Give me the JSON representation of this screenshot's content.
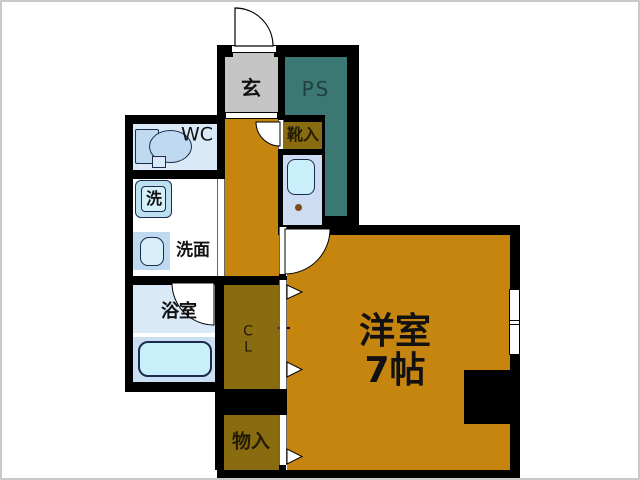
{
  "title": "apartment-floor-plan",
  "rooms": {
    "genkan": {
      "label": "玄"
    },
    "ps": {
      "label": "PS"
    },
    "wc": {
      "label": "WC"
    },
    "washer": {
      "label": "洗"
    },
    "washroom": {
      "label": "洗面"
    },
    "bathroom": {
      "label": "浴室"
    },
    "shoebox": {
      "label": "靴入"
    },
    "closet": {
      "label": "C\nL"
    },
    "storage": {
      "label": "物入"
    },
    "main_room": {
      "label": "洋室\n7帖"
    }
  },
  "colors": {
    "wall": "#000000",
    "orange": "#C6850E",
    "olive": "#8A6C10",
    "teal": "#3B7874",
    "gray": "#C5C5C5",
    "blue1": "#D9E9F8",
    "blue2": "#CDDCF2",
    "bathlower": "#CBDFF3",
    "cyan": "#C9EFFA",
    "washouter": "#BCE0F0",
    "washinner": "#D6F1F9",
    "sinkouter": "#BFD9F1",
    "sinkinner": "#D8EEF9",
    "labelcolor": "#111111",
    "pslabel": "#20403C",
    "frame": "#C9C9C9",
    "dot": "#7A4A18",
    "fixborder": "#1B2B4B"
  }
}
